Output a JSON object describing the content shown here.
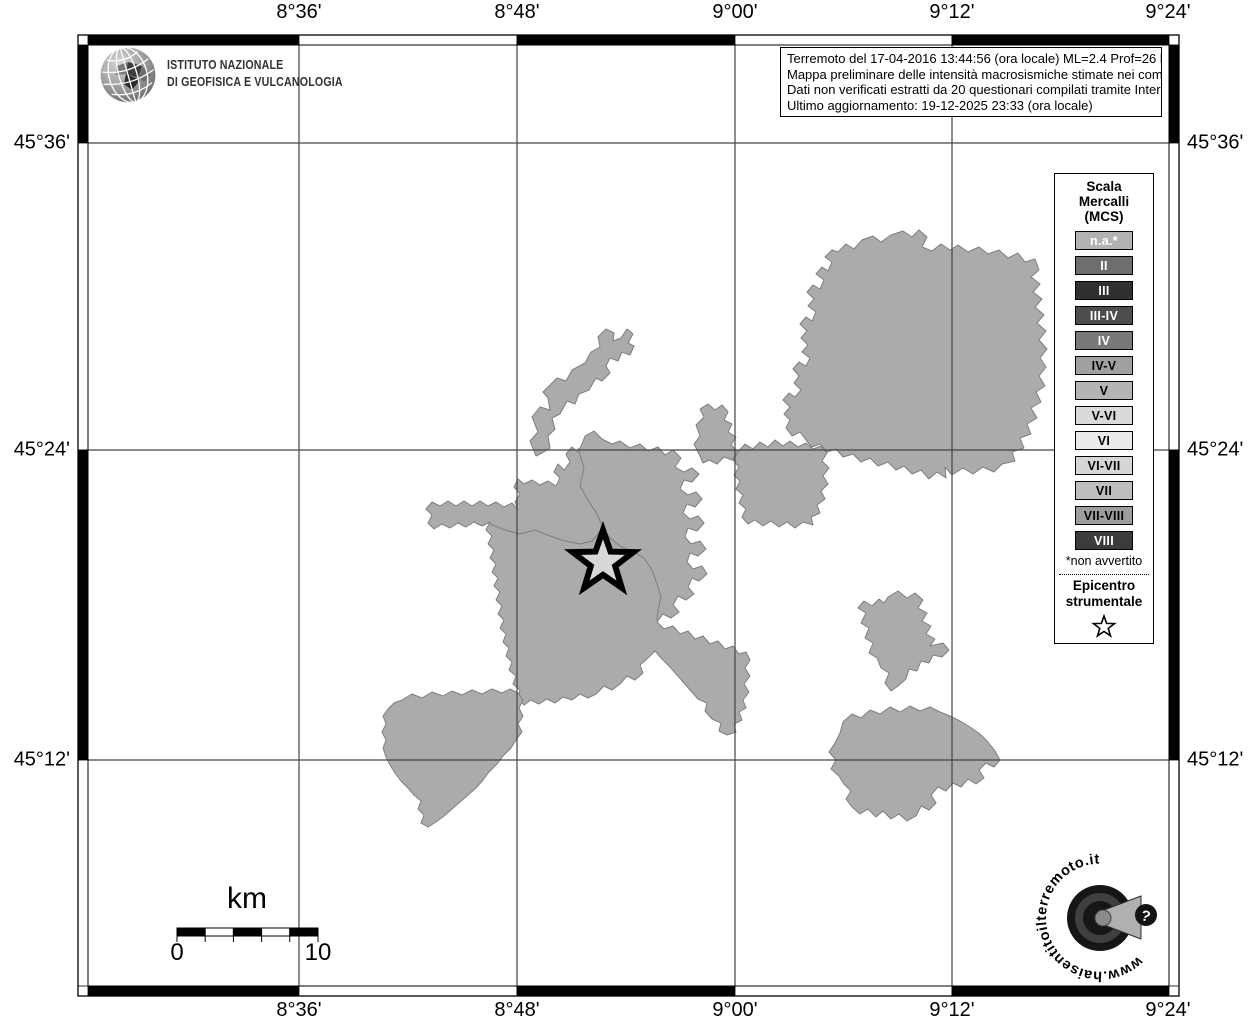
{
  "branding": {
    "ingv_line1": "ISTITUTO NAZIONALE",
    "ingv_line2": "DI GEOFISICA E VULCANOLOGIA"
  },
  "info_box": {
    "lines": [
      "Terremoto del 17-04-2016 13:44:56 (ora locale) ML=2.4 Prof=26 km",
      "Mappa preliminare delle intensità macrosismiche stimate nei comuni",
      "Dati non verificati estratti da 20 questionari compilati tramite Internet.",
      "Ultimo aggiornamento: 19-12-2025 23:33 (ora locale)"
    ]
  },
  "axes": {
    "top": [
      "8°36'",
      "8°48'",
      "9°00'",
      "9°12'",
      "9°24'"
    ],
    "bottom": [
      "8°36'",
      "8°48'",
      "9°00'",
      "9°12'",
      "9°24'"
    ],
    "left": [
      "45°36'",
      "45°24'",
      "45°12'"
    ],
    "right": [
      "45°36'",
      "45°24'",
      "45°12'"
    ]
  },
  "legend": {
    "title_lines": [
      "Scala",
      "Mercalli",
      "(MCS)"
    ],
    "items": [
      {
        "label": "n.a.*",
        "bg": "#b2b2b2",
        "fg": "#ffffff"
      },
      {
        "label": "II",
        "bg": "#6e6e6e",
        "fg": "#ffffff"
      },
      {
        "label": "III",
        "bg": "#303030",
        "fg": "#ffffff"
      },
      {
        "label": "III-IV",
        "bg": "#4d4d4d",
        "fg": "#ffffff"
      },
      {
        "label": "IV",
        "bg": "#787878",
        "fg": "#ffffff"
      },
      {
        "label": "IV-V",
        "bg": "#a0a0a0",
        "fg": "#000000"
      },
      {
        "label": "V",
        "bg": "#b4b4b4",
        "fg": "#000000"
      },
      {
        "label": "V-VI",
        "bg": "#dadada",
        "fg": "#000000"
      },
      {
        "label": "VI",
        "bg": "#eaeaea",
        "fg": "#000000"
      },
      {
        "label": "VI-VII",
        "bg": "#d6d6d6",
        "fg": "#000000"
      },
      {
        "label": "VII",
        "bg": "#bebebe",
        "fg": "#000000"
      },
      {
        "label": "VII-VIII",
        "bg": "#9d9d9d",
        "fg": "#000000"
      },
      {
        "label": "VIII",
        "bg": "#3c3c3c",
        "fg": "#ffffff"
      }
    ],
    "footnote": "*non avvertito",
    "epicenter_lines": [
      "Epicentro",
      "strumentale"
    ]
  },
  "scalebar": {
    "unit": "km",
    "start_label": "0",
    "end_label": "10"
  },
  "watermark": {
    "url": "www.haisentitoilterremoto.it",
    "question_mark": "?"
  },
  "map": {
    "colors": {
      "municipality_fill": "#ababab",
      "municipality_stroke": "#7e7e7e",
      "gridline": "#444444",
      "frame": "#000000",
      "star_fill": "#d8d8d8",
      "star_stroke": "#000000"
    },
    "epicenter": {
      "x": 603,
      "y": 562,
      "outer_r": 32,
      "inner_ratio": 0.4
    },
    "municipalities": [
      {
        "points": "536,456 530,441 538,432 532,417 540,407 550,410 548,398 543,392 557,378 566,381 572,370 585,363 591,352 600,347 598,337 606,329 614,333 613,341 621,338 627,329 633,334 628,343 634,346 630,355 622,352 618,361 610,358 606,366 610,373 602,381 596,378 589,390 579,394 575,404 567,401 560,414 552,418 555,429 548,436 550,448 542,453"
      },
      {
        "points": "838,252 846,244 854,249 862,240 873,236 881,242 891,235 903,231 912,237 919,230 927,237 922,247 932,251 941,244 950,250 958,245 968,252 979,247 988,254 999,250 1008,258 1018,253 1025,262 1035,259 1039,270 1031,277 1040,284 1033,292 1042,299 1035,307 1044,315 1037,323 1046,331 1039,340 1047,349 1040,358 1046,367 1039,376 1045,386 1036,392 1041,402 1031,408 1037,418 1027,424 1031,434 1020,438 1024,448 1012,452 1015,461 1002,464 994,472 983,467 973,474 963,468 952,475 945,467 946,478 937,472 929,479 921,470 912,474 904,466 896,470 888,462 878,466 870,458 861,462 853,454 843,457 836,449 827,452 820,444 812,447 806,440 800,432 792,436 786,428 790,420 784,414 790,407 783,400 789,393 795,397 801,390 794,383 799,376 793,369 799,362 806,366 810,358 802,352 808,345 801,338 807,331 800,324 806,317 812,321 816,312 808,306 814,299 807,292 813,285 820,289 824,280 816,274 822,267 828,271 832,262 825,257 832,250"
      },
      {
        "points": "585,436 594,431 602,439 612,444 620,441 630,448 640,444 648,451 658,447 665,455 673,450 681,458 675,467 684,472 692,468 699,474 692,482 684,480 680,489 688,495 696,492 702,499 695,507 687,504 683,513 690,519 698,516 704,523 697,531 688,528 685,537 691,544 700,541 706,549 698,556 690,553 687,562 693,569 702,566 707,574 699,581 692,578 688,587 694,594 686,600 678,596 673,605 679,612 671,618 663,614 657,622 664,629 673,626 680,634 688,631 695,639 703,636 710,644 718,641 725,649 733,646 739,654 746,652 750,660 745,668 750,676 744,684 749,692 743,700 746,708 739,712 742,720 734,724 736,732 727,735 719,731 721,723 712,719 705,711 707,703 698,699 691,691 684,683 677,675 670,667 662,659 655,651 648,658 640,665 643,673 635,680 627,676 620,684 612,690 604,686 596,694 588,698 580,694 572,700 563,697 555,703 547,699 539,704 531,700 524,705 518,698 520,690 513,684 516,676 509,670 512,662 506,656 509,648 503,642 506,634 500,628 504,620 498,614 502,606 496,600 500,592 494,586 498,578 492,572 496,564 490,558 494,550 488,544 492,536 486,530 490,522 482,526 474,522 466,527 458,523 450,528 442,524 434,529 428,523 432,515 426,509 432,502 440,506 448,501 456,506 464,501 472,506 480,501 488,506 496,502 504,507 512,503 518,510 515,502 520,494 514,487 518,479 524,484 532,480 540,485 548,481 556,486 560,478 554,472 558,464 564,470 570,462 566,454 572,447 578,452 582,444"
      },
      {
        "points": "402,700 412,694 422,698 432,692 443,696 452,691 462,695 472,690 482,694 492,689 502,693 510,689 518,693 523,700 519,708 523,716 518,724 522,732 516,740 511,748 503,756 497,764 489,772 483,780 476,788 468,795 460,802 452,809 444,816 436,822 428,827 421,823 424,815 418,809 421,801 414,795 408,788 401,781 395,773 390,765 386,757 383,748 386,740 382,732 386,724 383,716 388,709 394,703"
      },
      {
        "points": "700,456 694,444 700,436 696,425 704,417 700,409 708,404 715,410 722,405 728,412 724,420 732,424 728,432 736,437 731,445 738,452 732,460 724,457 717,464 709,460 703,463"
      },
      {
        "points": "738,452 745,444 753,449 760,442 768,447 775,440 783,446 790,441 798,447 806,443 813,449 821,446 827,453 822,461 829,468 823,476 828,484 821,491 825,499 817,505 820,513 811,517 813,525 803,522 795,528 787,522 779,527 771,521 763,526 755,520 748,524 742,517 746,509 739,503 743,495 736,489 740,481 734,475 739,467 733,460"
      },
      {
        "points": "888,597 898,591 907,598 915,593 923,600 918,608 927,613 922,621 931,626 926,634 935,639 930,646 943,643 949,650 942,657 933,655 929,663 921,661 917,671 909,669 906,679 898,686 891,691 885,683 889,673 881,668 877,658 869,653 873,643 865,638 869,628 861,623 866,613 858,608 864,601 872,606 879,599 884,603"
      },
      {
        "points": "843,722 852,714 861,718 870,710 880,714 890,707 900,712 910,706 920,711 930,707 940,712 950,716 960,721 970,727 980,734 988,742 995,751 1000,760 994,767 986,763 979,770 984,778 976,784 968,779 961,787 953,783 946,791 938,787 931,795 936,803 929,810 921,806 916,816 907,821 899,814 891,819 883,811 876,817 868,809 860,814 852,807 846,799 851,791 844,784 839,776 831,769 836,760 829,752 835,743 840,733"
      }
    ],
    "internal_borders": [
      "578,448 584,468 580,486 588,500 597,514 603,528 610,538 620,546 632,551 644,558 652,570 657,584 661,597 658,610 657,621",
      "490,524 505,530 520,534 535,530 550,536 565,541 580,544 592,541 603,528"
    ]
  }
}
